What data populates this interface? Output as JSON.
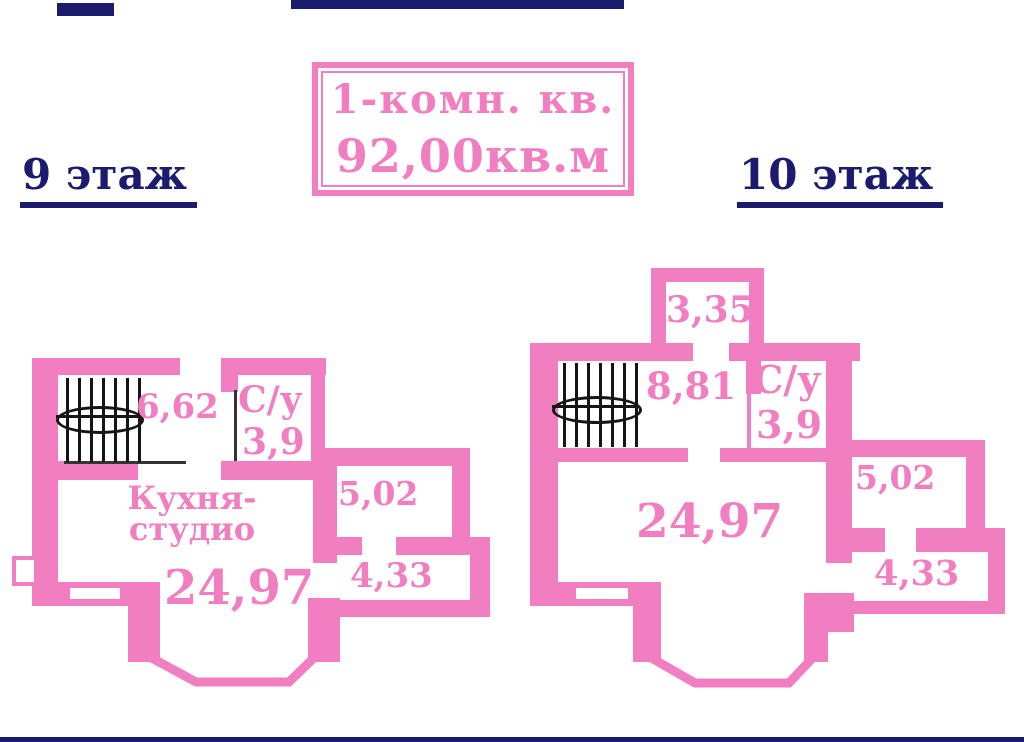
{
  "colors": {
    "pink": "#f07ec0",
    "navy": "#1b1b6f"
  },
  "title_box": {
    "line1": "1-комн. кв.",
    "line2": "92,00кв.м"
  },
  "floor_labels": {
    "left": "9 этаж",
    "right": "10 этаж"
  },
  "plan_left": {
    "stairs_area": "6,62",
    "bathroom_label": "С/у",
    "bathroom_area": "3,9",
    "kitchen_line1": "Кухня-",
    "kitchen_line2": "студио",
    "kitchen_area": "24,97",
    "room_top_area": "5,02",
    "room_bottom_area": "4,33"
  },
  "plan_right": {
    "balcony_area": "3,35",
    "stairs_area": "8,81",
    "bathroom_label": "С/у",
    "bathroom_area": "3,9",
    "main_area": "24,97",
    "room_top_area": "5,02",
    "room_bottom_area": "4,33"
  }
}
